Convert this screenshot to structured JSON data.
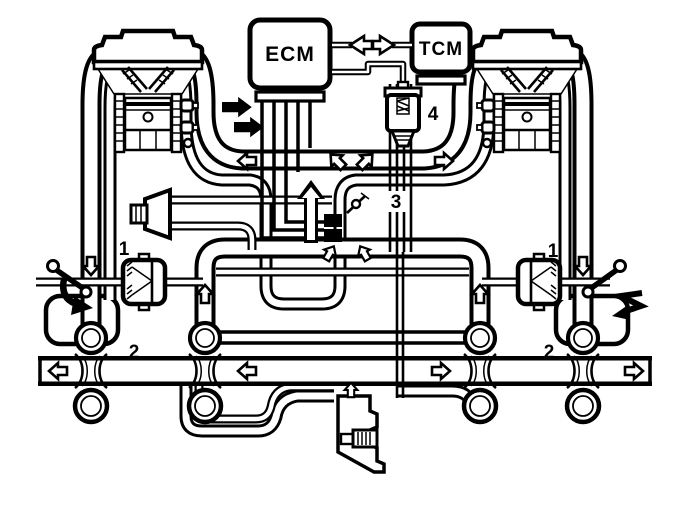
{
  "colors": {
    "ink": "#000000",
    "paper": "#ffffff"
  },
  "modules": {
    "ecm_label": "ECM",
    "tcm_label": "TCM"
  },
  "callouts": {
    "one_left": "1",
    "one_right": "1",
    "two_left": "2",
    "two_right": "2",
    "three": "3",
    "four": "4"
  }
}
